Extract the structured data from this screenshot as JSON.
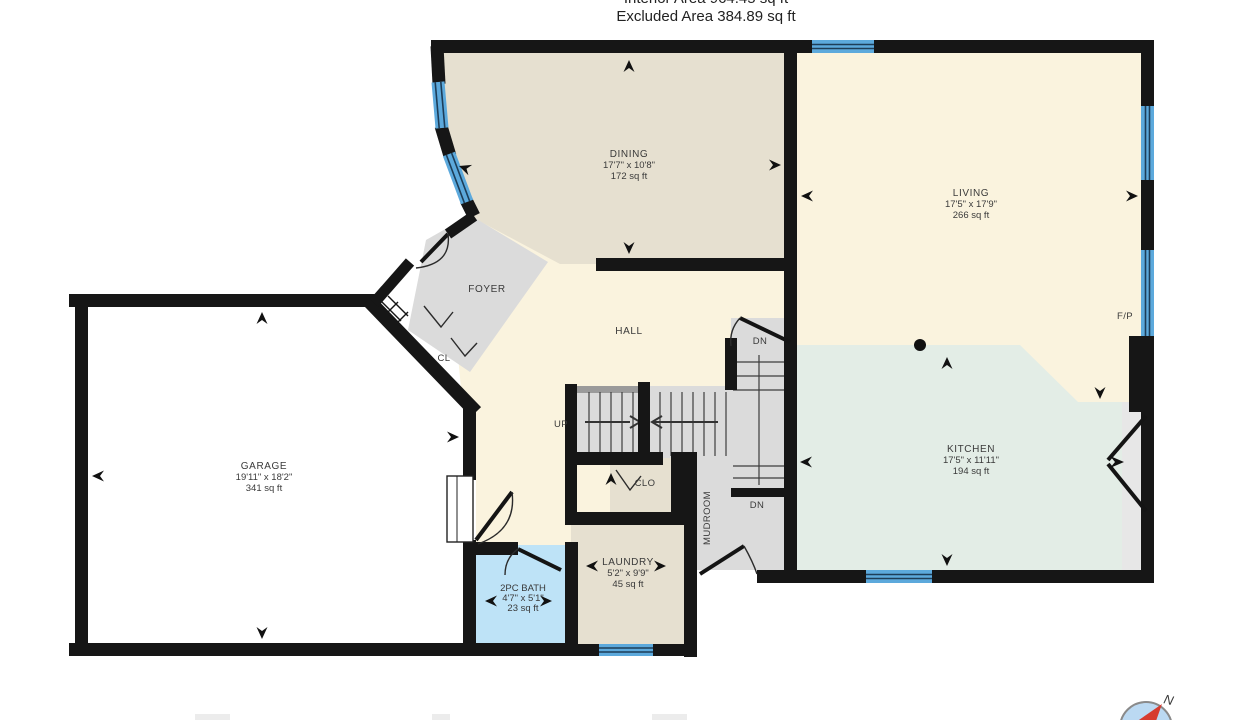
{
  "header": {
    "line1": "Interior Area 964.45 sq ft",
    "line2": "Excluded Area 384.89 sq ft"
  },
  "rooms": {
    "dining": {
      "name": "DINING",
      "dims": "17'7\" x 10'8\"",
      "area": "172 sq ft"
    },
    "living": {
      "name": "LIVING",
      "dims": "17'5\" x 17'9\"",
      "area": "266 sq ft"
    },
    "kitchen": {
      "name": "KITCHEN",
      "dims": "17'5\" x 11'11\"",
      "area": "194 sq ft"
    },
    "garage": {
      "name": "GARAGE",
      "dims": "19'11\" x 18'2\"",
      "area": "341 sq ft"
    },
    "laundry": {
      "name": "LAUNDRY",
      "dims": "5'2\" x 9'9\"",
      "area": "45 sq ft"
    },
    "bath": {
      "name": "2PC BATH",
      "dims": "4'7\" x 5'1\"",
      "area": "23 sq ft"
    }
  },
  "labels": {
    "foyer": "FOYER",
    "hall": "HALL",
    "cl": "CL",
    "clo": "CLO",
    "mudroom": "MUDROOM",
    "up": "UP",
    "dn_top": "DN",
    "dn_bottom": "DN",
    "fireplace": "F/P",
    "compass_north": "N"
  },
  "colors": {
    "wall": "#161616",
    "window_blue": "#5CA9DC",
    "window_line": "#1d3d58",
    "dining_beige": "#E6E0D0",
    "living_cream": "#FAF3DE",
    "kitchen_green": "#E3EDE6",
    "gray_room": "#DBDBDB",
    "bath_blue": "#BEE3F7",
    "garage_white": "#FFFFFF",
    "counter_gray": "#E7E7E7",
    "compass_red": "#D63B2F",
    "compass_fill": "#BBD9F2"
  }
}
